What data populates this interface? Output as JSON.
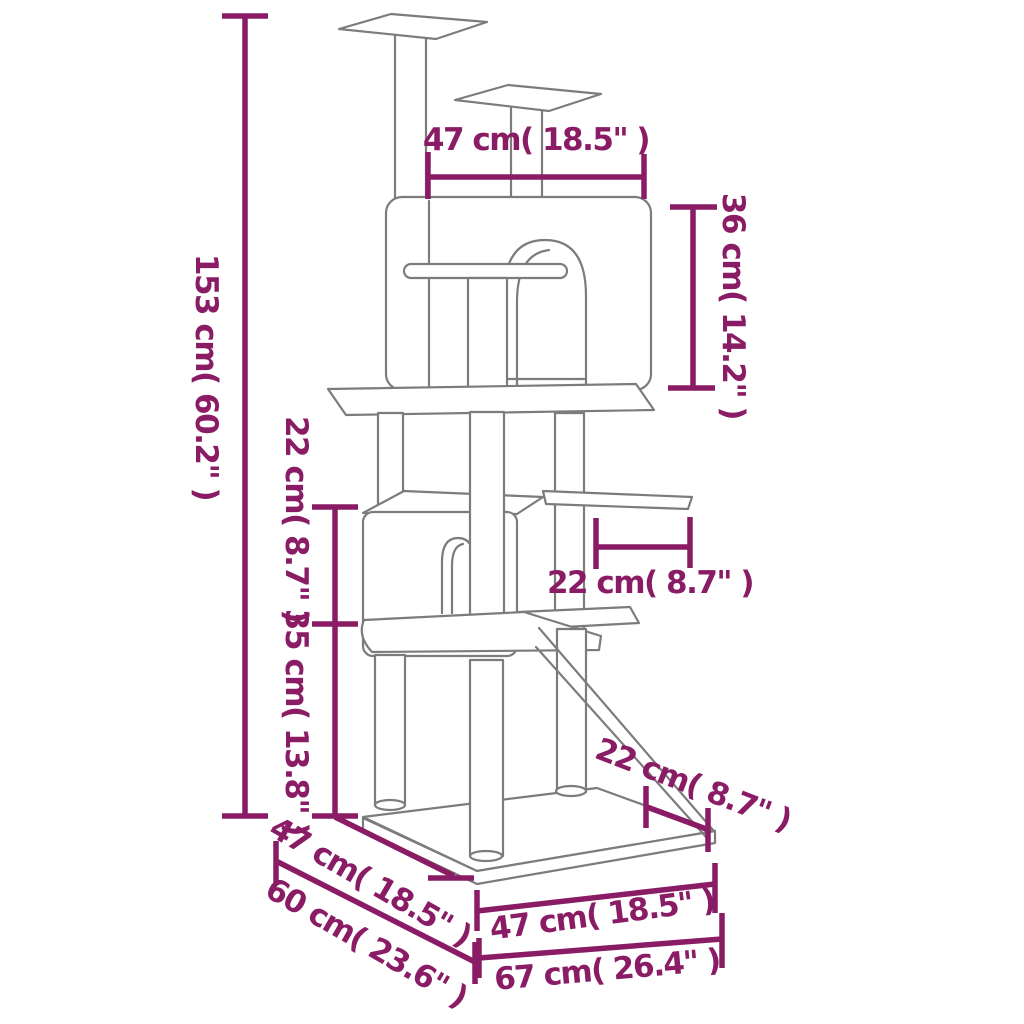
{
  "diagram": {
    "product": "cat-tree-with-scratching-posts-dimension-diagram",
    "colors": {
      "dimension": "#8a1c66",
      "outline": "#7c7c7c",
      "background": "#ffffff"
    },
    "dimensions": {
      "total_height": "153 cm( 60.2\" )",
      "top_platform_width": "47 cm( 18.5\" )",
      "condo_height": "36 cm( 14.2\" )",
      "upper_section_height": "22 cm( 8.7\" )",
      "lower_section_height": "35 cm( 13.8\" )",
      "side_platform_depth": "22 cm( 8.7\" )",
      "ramp_foot_offset": "22 cm( 8.7\" )",
      "base_side_depth": "47 cm( 18.5\" )",
      "base_total_depth": "60 cm( 23.6\" )",
      "base_front_width": "47 cm( 18.5\" )",
      "base_total_width": "67 cm( 26.4\" )"
    }
  }
}
